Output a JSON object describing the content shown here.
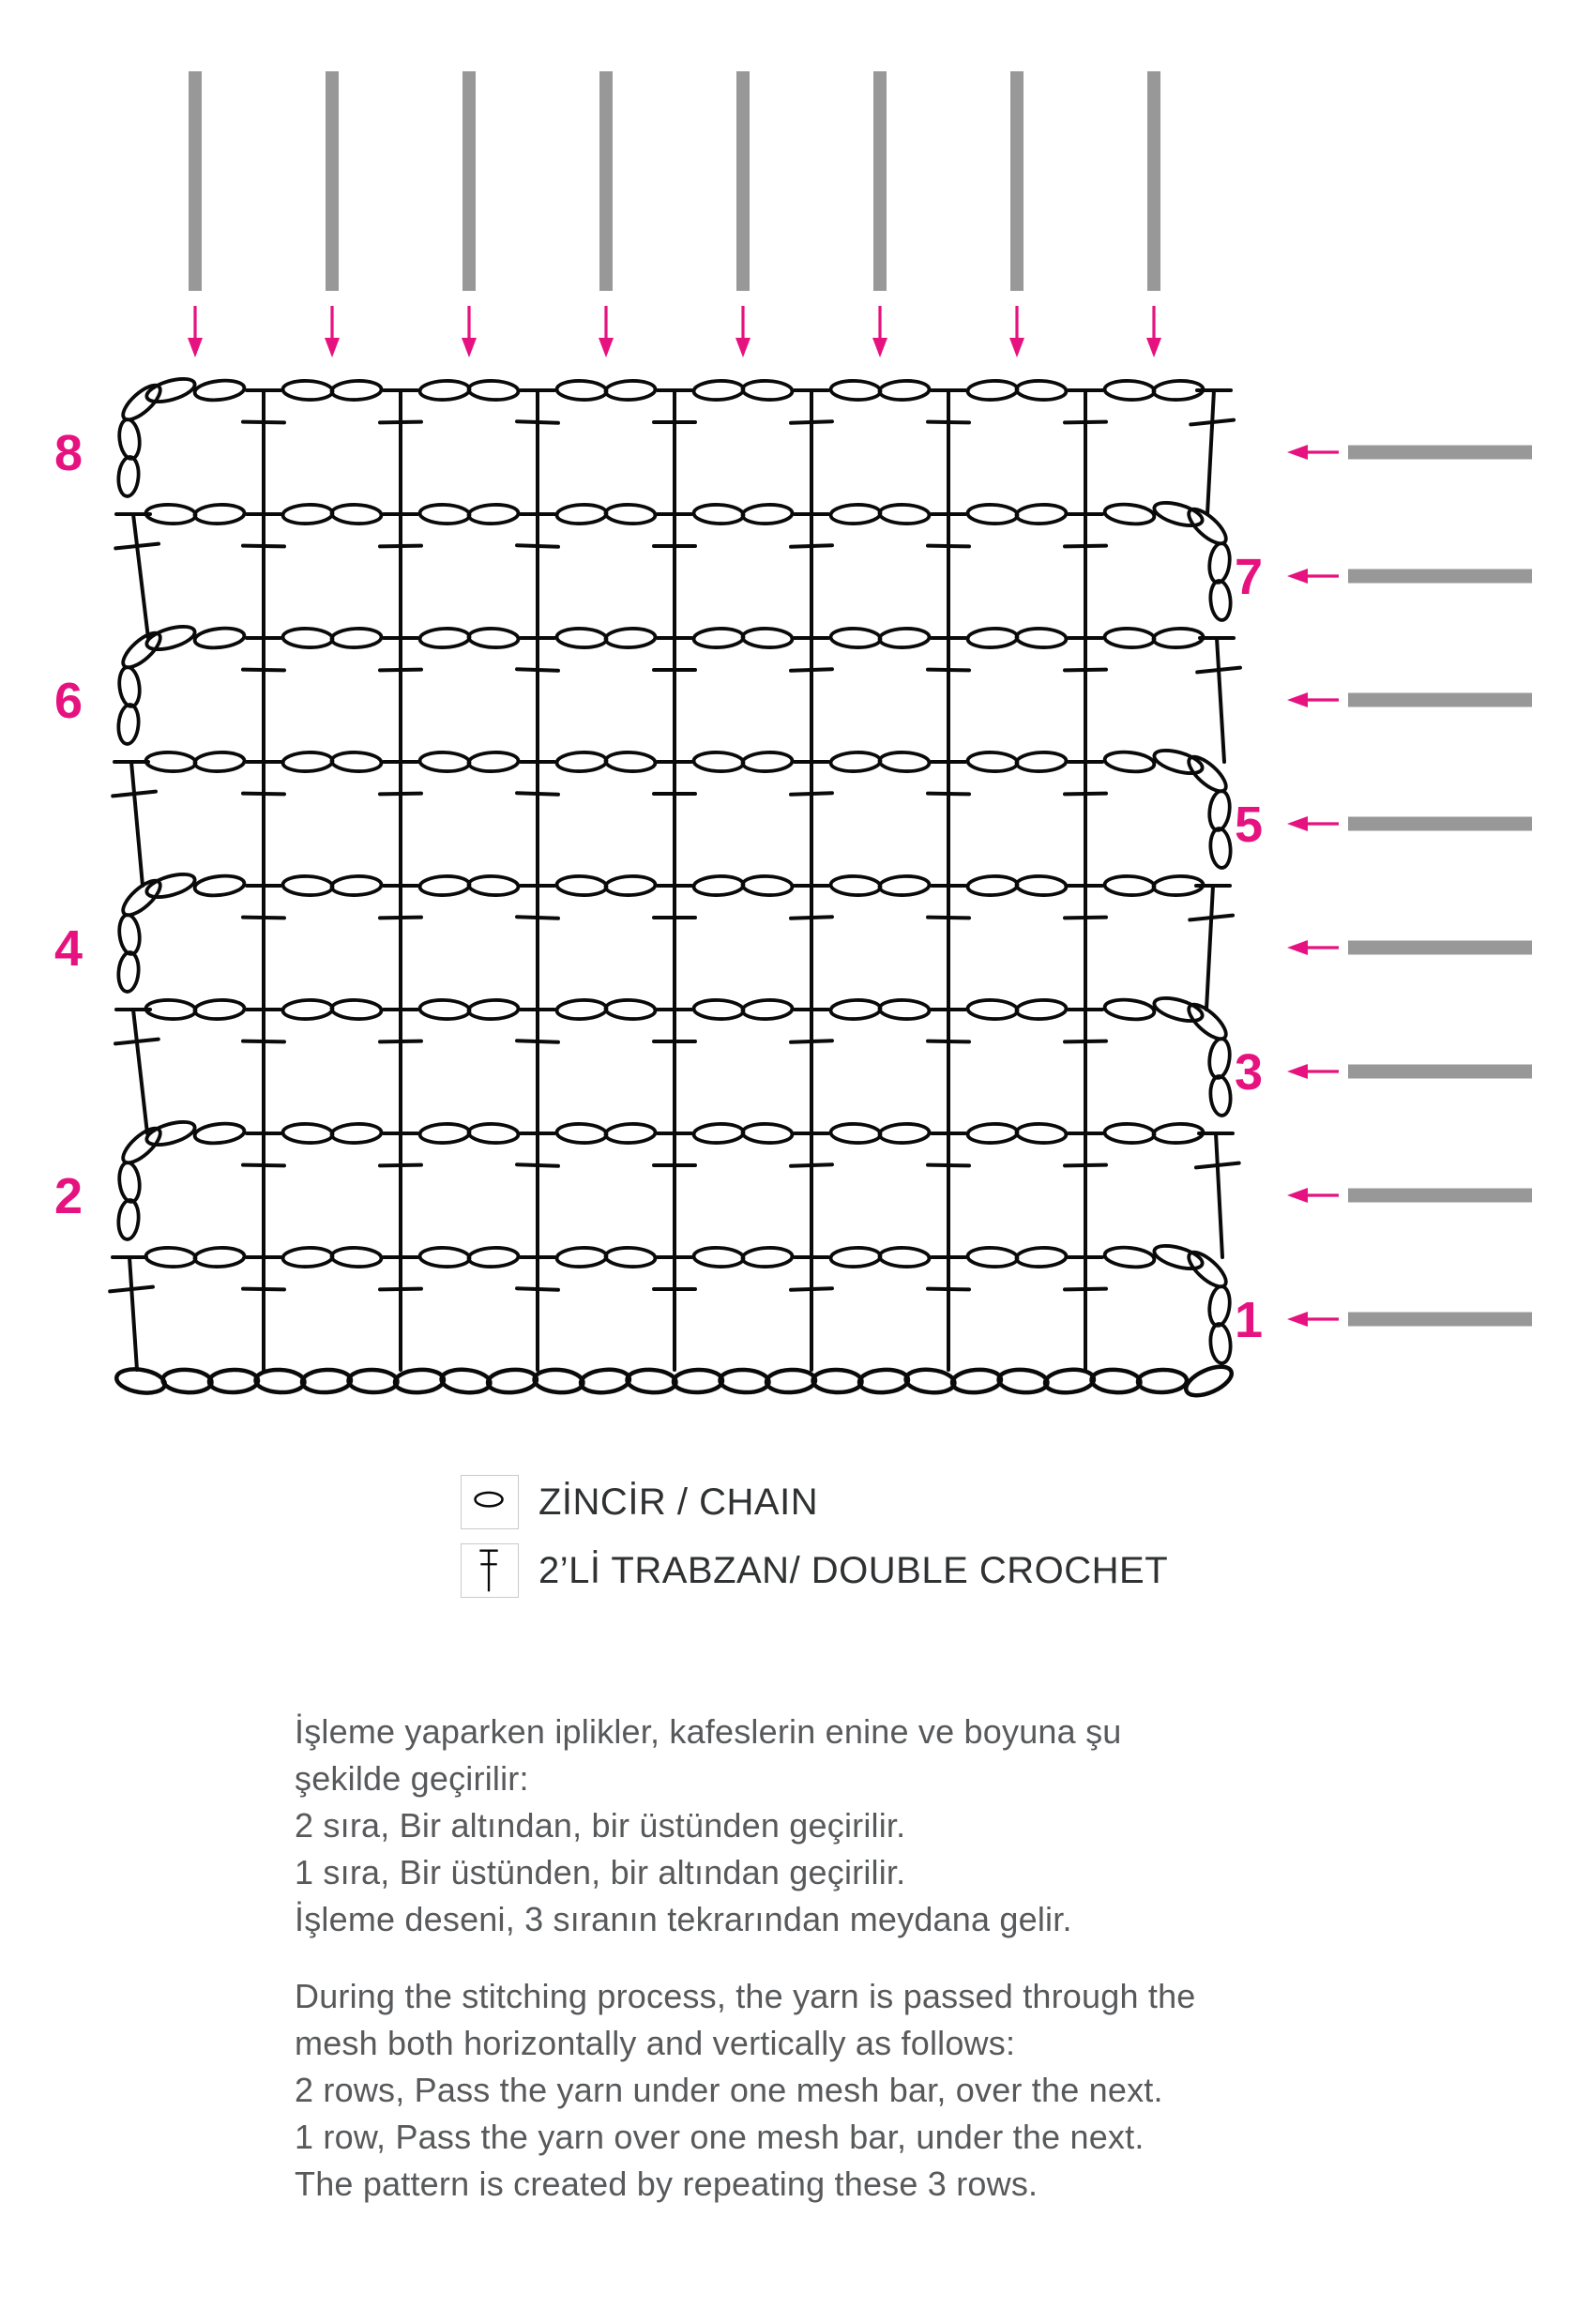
{
  "colors": {
    "pink": "#E6127F",
    "gray": "#989898",
    "ink": "#0A0A0A",
    "text": "#58595B",
    "legend_text": "#2F3132",
    "legend_border": "#C8CACC"
  },
  "diagram": {
    "rows": 8,
    "cols": 8,
    "row_numbers_left": [
      "8",
      "6",
      "4",
      "2"
    ],
    "row_numbers_right": [
      "7",
      "5",
      "3",
      "1"
    ],
    "top_bars": 8,
    "side_bars": 8,
    "foundation_chain_count": 24
  },
  "legend": {
    "items": [
      {
        "icon": "chain-icon",
        "label": "ZİNCİR / CHAIN"
      },
      {
        "icon": "double-crochet-icon",
        "label": "2’Lİ TRABZAN/ DOUBLE CROCHET"
      }
    ]
  },
  "notes": {
    "turkish": "İşleme yaparken iplikler, kafeslerin enine ve boyuna şu\nşekilde geçirilir:\n2 sıra, Bir altından, bir üstünden geçirilir.\n1 sıra, Bir üstünden, bir altından geçirilir.\nİşleme deseni, 3 sıranın tekrarından meydana gelir.",
    "english": "During the stitching process, the yarn is passed through the\nmesh both horizontally and vertically as follows:\n2 rows, Pass the yarn under one mesh bar, over the next.\n1 row, Pass the yarn over one mesh bar, under the next.\nThe pattern is created by repeating these 3 rows."
  }
}
